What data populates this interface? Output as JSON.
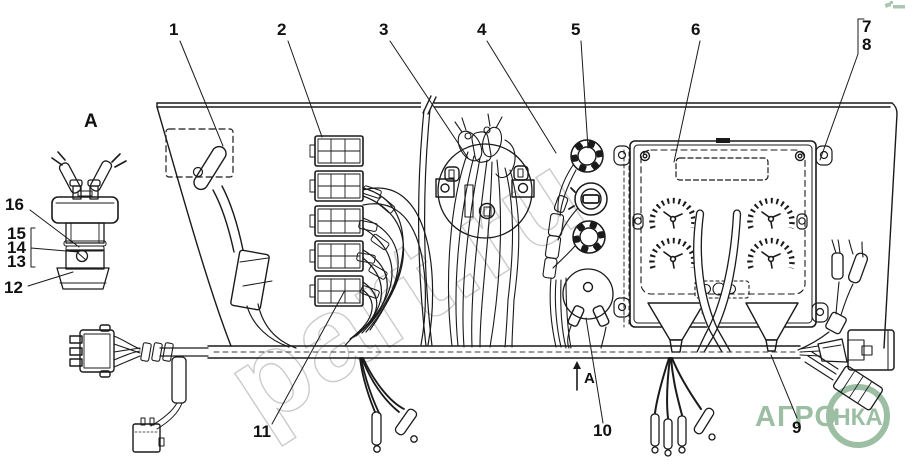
{
  "callouts": {
    "c1": "1",
    "c2": "2",
    "c3": "3",
    "c4": "4",
    "c5": "5",
    "c6": "6",
    "c7": "7",
    "c8": "8",
    "c9": "9",
    "c10": "10",
    "c11": "11",
    "c12": "12",
    "c13": "13",
    "c14": "14",
    "c15": "15",
    "c16": "16"
  },
  "labels": {
    "detail_view": "A",
    "view_arrow": "A"
  },
  "watermarks": {
    "diagonal": "part.ru",
    "logo_left": "АГРО",
    "logo_circle": "НКА"
  },
  "colors": {
    "line": "#1a1a1a",
    "watermark_green": "#9cbfa4",
    "watermark_gray": "#c9cdc9",
    "background": "#ffffff"
  }
}
